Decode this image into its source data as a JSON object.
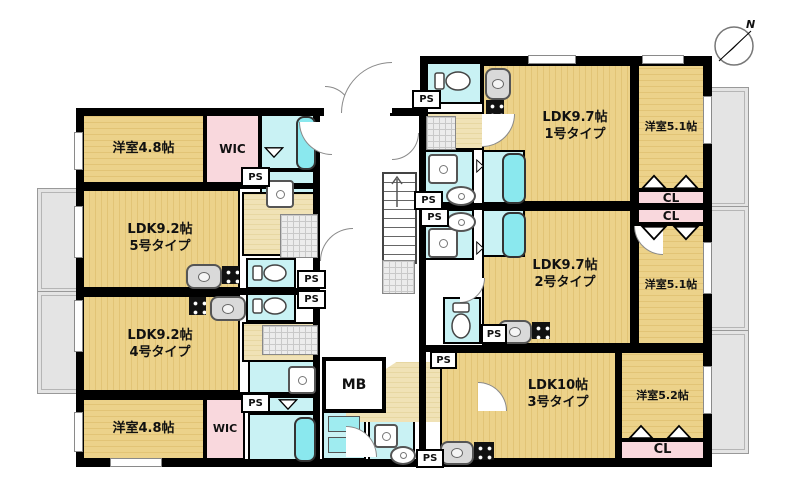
{
  "compass": {
    "north": "N"
  },
  "labels": {
    "ps": "PS",
    "mb": "MB",
    "wic": "WIC",
    "cl": "CL"
  },
  "units": {
    "u5": {
      "ldk": "LDK9.2帖",
      "type": "5号タイプ",
      "bedroom": "洋室4.8帖"
    },
    "u4": {
      "ldk": "LDK9.2帖",
      "type": "4号タイプ",
      "bedroom": "洋室4.8帖"
    },
    "u1": {
      "ldk": "LDK9.7帖",
      "type": "1号タイプ",
      "bedroom": "洋室5.1帖"
    },
    "u2": {
      "ldk": "LDK9.7帖",
      "type": "2号タイプ",
      "bedroom": "洋室5.1帖"
    },
    "u3": {
      "ldk": "LDK10帖",
      "type": "3号タイプ",
      "bedroom": "洋室5.2帖"
    }
  },
  "colors": {
    "room_yellow": "#ecd28a",
    "room_pink": "#f9d8dd",
    "room_cyan": "#c9f2f4",
    "hall_beige": "#f0e2b6",
    "balcony_gray": "#e4e4e4",
    "tub_cyan": "#8ae8ee",
    "wall": "#000000"
  }
}
